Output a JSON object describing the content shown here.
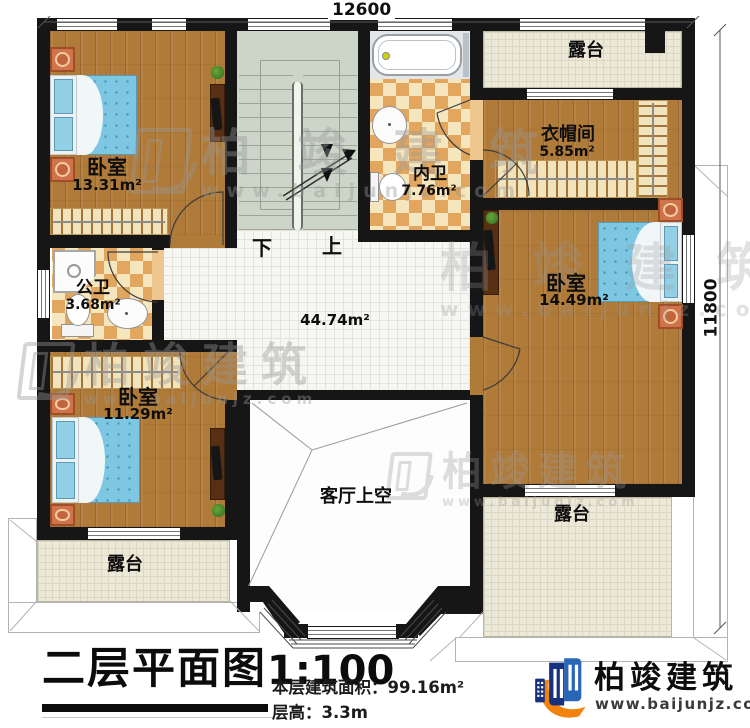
{
  "dimensions": {
    "top": "12600",
    "right": "11800"
  },
  "stairs": {
    "down": "下",
    "up": "上"
  },
  "rooms": {
    "bedroom1": {
      "name": "卧室",
      "area": "13.31m²"
    },
    "ensuite_bath": {
      "name": "内卫",
      "area": "7.76m²"
    },
    "closet": {
      "name": "衣帽间",
      "area": "5.85m²"
    },
    "terrace_top": {
      "name": "露台"
    },
    "bedroom2": {
      "name": "卧室",
      "area": "14.49m²"
    },
    "public_bath": {
      "name": "公卫",
      "area": "3.68m²"
    },
    "bedroom3": {
      "name": "卧室",
      "area": "11.29m²"
    },
    "terrace_bottom_left": {
      "name": "露台"
    },
    "terrace_bottom_right": {
      "name": "露台"
    },
    "living_room_void": {
      "name": "客厅上空"
    },
    "hall": {
      "area": "44.74m²"
    }
  },
  "title": {
    "text": "二层平面图",
    "scale": "1:100"
  },
  "info": {
    "floor_area": "本层建筑面积：99.16m²",
    "floor_height": "层高：3.3m"
  },
  "branding": {
    "company": "柏竣建筑",
    "website": "www.baijunjz.com"
  },
  "watermark": {
    "company": "柏竣建筑",
    "website": "www.baijunjz.com"
  },
  "colors": {
    "wall": "#161616",
    "wood": "#b07a39",
    "terrace": "#ece9d8",
    "stair": "#ccd5c7",
    "checker_light": "#f6e6bd",
    "checker_dark": "#e2a65f",
    "logo_blue_dark": "#16327e",
    "logo_blue_light": "#2a66b8",
    "logo_orange": "#f2820a"
  }
}
